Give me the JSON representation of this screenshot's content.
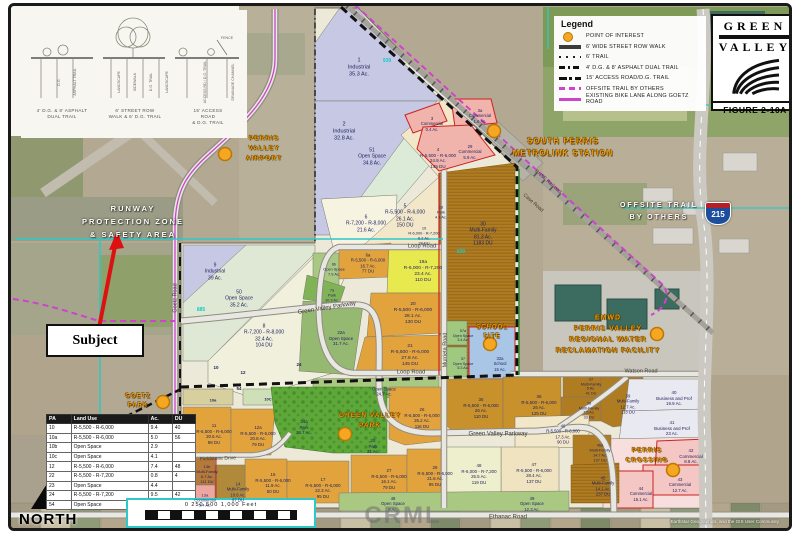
{
  "legend": {
    "title": "Legend",
    "items": [
      {
        "icon": "poi-circle-icon",
        "label": "POINT OF INTEREST"
      },
      {
        "icon": "walk-line-icon",
        "label": "6' WIDE STREET ROW WALK"
      },
      {
        "icon": "trail-dots-icon",
        "label": "6' TRAIL"
      },
      {
        "icon": "dual-trail-dash-icon",
        "label": "4' D.G. & 8' ASPHALT DUAL TRAIL"
      },
      {
        "icon": "access-road-dash-icon",
        "label": "15' ACCESS ROAD/D.G. TRAIL"
      },
      {
        "icon": "offsite-dash-icon",
        "label": "OFFSITE TRAIL BY OTHERS"
      },
      {
        "icon": "bike-lane-line-icon",
        "label": "EXISTING BIKE LANE ALONG GOETZ ROAD"
      }
    ]
  },
  "logo": {
    "line1": "GREEN",
    "line2": "VALLEY",
    "figure": "FIGURE 2-10A"
  },
  "sections": {
    "s1_caption": "4' D.G. & 8' ASPHALT\nDUAL TRAIL",
    "s1_l1": "D.G.",
    "s1_l2": "ASPHALT TRAIL",
    "s2_caption": "6' STREET ROW\nWALK & 6' D.G. TRAIL",
    "s2_l1": "LANDSCAPE",
    "s2_l2": "SIDEWALK",
    "s2_l3": "D.G. TRAIL",
    "s2_l4": "LANDSCAPE",
    "s3_caption": "15' ACCESS ROAD\n& D.G. TRAIL",
    "s3_l1": "ACCESS RD / D.G. TRAIL",
    "s3_l2": "DRAINAGE CHANNEL",
    "s3_fence": "FENCE"
  },
  "table": {
    "headers": [
      "PA",
      "Land Use",
      "Ac.",
      "DU"
    ],
    "rows": [
      [
        "10",
        "R-5,500 - R-6,000",
        "9.4",
        "40"
      ],
      [
        "10a",
        "R-5,500 - R-6,000",
        "5.0",
        "56"
      ],
      [
        "10b",
        "Open Space",
        "2.9",
        ""
      ],
      [
        "10c",
        "Open Space",
        "4.1",
        ""
      ],
      [
        "12",
        "R-5,500 - R-6,000",
        "7.4",
        "48"
      ],
      [
        "22",
        "R-5,500 - R-7,200",
        "0.8",
        "4"
      ],
      [
        "23",
        "Open Space",
        "4.4",
        ""
      ],
      [
        "24",
        "R-5,500 - R-7,200",
        "9.5",
        "42"
      ],
      [
        "54",
        "Open Space",
        "7.9",
        ""
      ]
    ]
  },
  "map": {
    "subject": "Subject",
    "north": "NORTH",
    "scale": "0   250   500        1,000 Feet",
    "interstate": "215",
    "watermark": "CRML",
    "attribution": "Earthstar Geographics, and the GIS User Community",
    "poi": {
      "airport": "PERRIS\nVALLEY\nAIRPORT",
      "metrolink": "SOUTH PERRIS\nMETROLINK STATION",
      "emwd": "EMWD\nPERRIS VALLEY\nREGIONAL WATER\nRECLAMATION FACILITY",
      "school": "SCHOOL\nSITE",
      "gvpark": "GREEN VALLEY\nPARK",
      "crossing": "PERRIS\nCROSSING",
      "goetzpark": "GOETZ\nPARK"
    },
    "zone": {
      "runway": "RUNWAY\nPROTECTION ZONE\n& SAFETY AREA",
      "offsite": "OFFSITE TRAIL\nBY OTHERS"
    },
    "roads": {
      "goetz": "Goetz Road",
      "gvp1": "Green Valley Parkway",
      "gvp2": "Green  Valley  Parkway",
      "loop1": "Loop Road",
      "loop2": "Loop Road",
      "murrieta": "Murrieta Road",
      "watson": "Watson Road",
      "ethanac": "Ethanac Road",
      "fieldstone": "Fieldstone Drive",
      "bnsf": "BNSF Railroad",
      "case": "Case Road"
    },
    "refs": {
      "r1": "939",
      "r2": "885",
      "r3": "839"
    },
    "parcels": {
      "p1": "1\nIndustrial\n35.3 Ac.",
      "p2": "2\nIndustrial\n32.8 Ac.",
      "p3": "3\nCommercial\n0.4 Ac.",
      "p3a": "3a\nCommercial\n1.6 Ac.",
      "p4": "4\nR-5,500 - R-6,000\n24.9 Ac.\n145 DU",
      "p5": "5\nR-5,500 - R-6,000\n26.1 Ac.\n150 DU",
      "p6": "6\nR-7,200 - R-8,000\n21.6 Ac.",
      "p6a": "6a\nR-5,500 - R-6,000\n16.7 Ac.\n77 DU",
      "p6b": "6b\nOpen Space\n7.9 Ac.",
      "p7a": "7a\nPark\n10.3 Ac.",
      "p8": "8\nR-7,200 - R-8,000\n32.4 Ac.\n104 DU",
      "p9": "9\nIndustrial\n39 Ac.",
      "p50": "50\nOpen Space\n35.2 Ac.",
      "p51": "51\nOpen Space\n34.8 Ac.",
      "p18": "18\nPark\n4.9 Ac.",
      "p19": "19\nR-6,000 - R-7,200\n6.2 Ac.\n28 DU",
      "p19a": "19a\nR-6,000 - R-7,200\n23.4 Ac.\n110 DU",
      "p20": "20\nR-5,500 - R-6,000\n28.1 Ac.\n130 DU",
      "p21": "21\nR-5,500 - R-6,000\n27.8 Ac.\n145 DU",
      "p22a": "22a\nOpen Space\n31.7 Ac.",
      "p29": "29\nCommercial\n5.9 Ac.",
      "p30": "30\nMulti-Family\n81.3 Ac.\n1183 DU",
      "p57a": "57a\nOpen Space\n3.4 Ac.",
      "p57": "57\nOpen Space\n5.3 Ac.",
      "p32a": "32a\nSchool\n15 Ac.",
      "p10": "10",
      "p12": "12",
      "p24": "24",
      "p54": "54",
      "p10a": "10a",
      "p10c": "10C",
      "posTop": "Open Space\n24.7 Ac.",
      "p11": "11\nR-5,500 - R-6,000\n20.6 Ac.\n98 DU",
      "p12a": "12a\nR-5,500 - R-6,000\n20.8 Ac.\n79 DU",
      "p24a": "24a\nPark\n26.7 Ac.",
      "p25": "25\nPark\n31 Ac.",
      "p26": "26\nR-5,500 - R-6,000\n26.2 Ac.\n116 DU",
      "p27": "27\nR-5,500 - R-6,000\n16.1 Ac.\n79 DU",
      "p28": "28\nR-5,500 - R-6,000\n21.6 Ac.\n95 DU",
      "p17": "17\nR-5,500 - R-6,000\n22.3 Ac.\n95 DU",
      "p16": "16\nR-5,500 - R-6,000\n11.9 Ac.\n50 DU",
      "p14": "14\nMulti-Family\n10.6 Ac.\n97 DU",
      "p13b": "13b\nMulti-Family\n6.7 Ac.\n111 DU",
      "p13a": "13a\nCommercial\n5.4 Ac.",
      "p35": "35\nR-5,500 - R-6,000\n26 Ac.\n110 DU",
      "p36": "36\nR-5,500 - R-6,000\n26 Ac.\n125 DU",
      "p37": "37\nMulti-Family\n5 Ac.\n41 DU",
      "p38": "38\nMulti-Family\n7.5 Ac.\n33 DU",
      "p39": "39\nMulti-Family\n12.7 Ac.\n113 DU",
      "p40": "40\nBusiness and Prof\n19.9 Ac.",
      "p41": "41\nBusiness and Prof\n23 Ac.",
      "p42": "42\nCommercial\n8.8 Ac.",
      "p43": "43\nCommercial\n12.7 Ac.",
      "p44": "44\nCommercial\n15.1 Ac.",
      "p45": "45\nMulti-Family\n14.1 Ac.\n237 DU",
      "p46": "46\nR-5,500 - R-6,000\n17.3 Ac.\n90 DU",
      "p46a": "46a\nMulti-Family\n14.7 Ac.\n137 DU",
      "p47": "47\nR-5,500 - R-6,000\n28.4 Ac.\n137 DU",
      "p48r": "48\nR-6,000 - R-7,200\n25.5 Ac.\n119 DU",
      "p48os": "48\nOpen Space\n9 Ac.",
      "p49": "49\nOpen Space\n12.3 Ac."
    }
  }
}
